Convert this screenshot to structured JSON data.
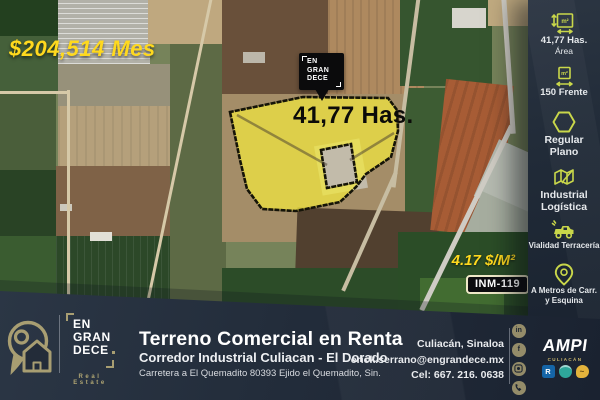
{
  "poster": {
    "price_month": "$204,514 Mes",
    "area_label": "41,77 Has.",
    "price_m2": "4.17 $/M²",
    "listing_code": "INM-119"
  },
  "marker": {
    "lines": [
      "EN",
      "GRAN",
      "DECE"
    ]
  },
  "sidebar": {
    "unit_m2": "m²",
    "items": [
      {
        "line1": "41,77  Has.",
        "line2": "Área"
      },
      {
        "line1": "150 Frente",
        "line2": ""
      },
      {
        "line1": "Regular",
        "line2": "Plano"
      },
      {
        "line1": "Industrial",
        "line2": "Logística"
      },
      {
        "line1": "Vialidad Terracería",
        "line2": ""
      },
      {
        "line1": "A Metros de Carr.",
        "line2": "y Esquina"
      }
    ]
  },
  "footer": {
    "brand": {
      "lines": [
        "EN",
        "GRAN",
        "DECE"
      ],
      "tagline": "Real Estate"
    },
    "title": "Terreno Comercial en Renta",
    "subtitle": "Corredor Industrial Culiacan - El Dorado",
    "address": "Carretera a El Quemadito 80393 Ejido el Quemadito, Sin.",
    "contact": {
      "city": "Culiacán, Sinaloa",
      "email": "erick.serrano@engrandece.mx",
      "phone": "Cel: 667. 216. 0638"
    },
    "social": {
      "linkedin": "in",
      "facebook": "f"
    },
    "ampi": {
      "name": "AMPI",
      "location": "CULIACÁN",
      "realtor_badge": "R"
    }
  },
  "colors": {
    "accent_yellow": "#ffd91e",
    "lime": "#c9d74a",
    "panel_navy": "#222c39",
    "gold": "#a89e72",
    "parcel_fill": "#f2e93e"
  }
}
